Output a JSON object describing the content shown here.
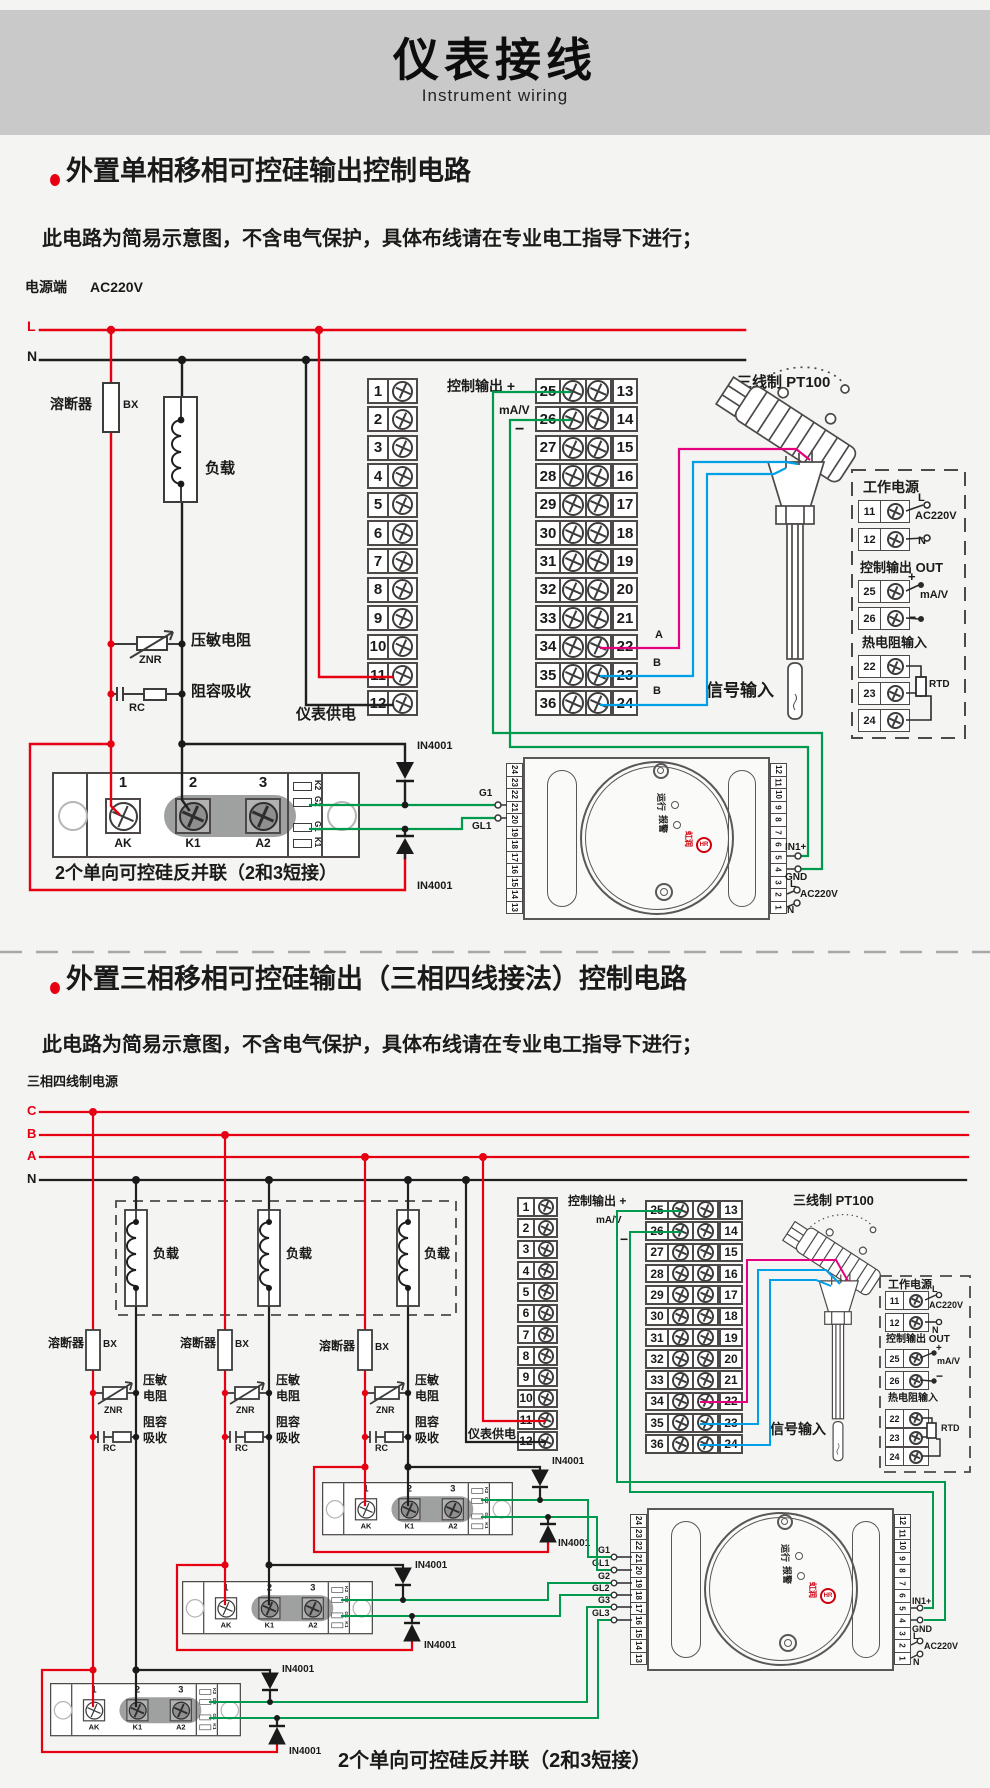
{
  "header": {
    "title": "仪表接线",
    "subtitle": "Instrument wiring"
  },
  "s1": {
    "title": "外置单相移相可控硅输出控制电路",
    "warning": "此电路为简易示意图，不含电气保护，具体布线请在专业电工指导下进行；",
    "power_label": "电源端",
    "power_voltage": "AC220V",
    "line_l": "L",
    "line_n": "N",
    "fuse_label": "溶断器",
    "fuse_code": "BX",
    "load_label": "负载",
    "varistor_label": "压敏电阻",
    "varistor_code": "ZNR",
    "rc_label": "阻容吸收",
    "rc_code": "RC",
    "meter_supply_label": "仪表供电",
    "ctrl_out_label": "控制输出 +",
    "ctrl_out_unit": "mA/V",
    "ctrl_out_minus": "−",
    "terminals_left": [
      "1",
      "2",
      "3",
      "4",
      "5",
      "6",
      "7",
      "8",
      "9",
      "10",
      "11",
      "12"
    ],
    "terminals_inner": [
      "25",
      "26",
      "27",
      "28",
      "29",
      "30",
      "31",
      "32",
      "33",
      "34",
      "35",
      "36"
    ],
    "terminals_outer": [
      "13",
      "14",
      "15",
      "16",
      "17",
      "18",
      "19",
      "20",
      "21",
      "22",
      "23",
      "24"
    ],
    "sig_a": "A",
    "sig_b1": "B",
    "sig_b2": "B",
    "signal_input_label": "信号输入",
    "pt100_label": "三线制 PT100",
    "diode_label": "IN4001",
    "gate_wire_g1": "G1",
    "gate_wire_gl1": "GL1",
    "caption": "2个单向可控硅反并联（2和3短接）",
    "side_panel": {
      "power_title": "工作电源",
      "t11": "11",
      "l": "L",
      "voltage": "AC220V",
      "t12": "12",
      "n": "N",
      "output_title": "控制输出 OUT",
      "t25": "25",
      "plus": "+",
      "unit": "mA/V",
      "t26": "26",
      "minus": "−",
      "rtd_title": "热电阻输入",
      "t22": "22",
      "t23": "23",
      "t24": "24",
      "rtd": "RTD"
    },
    "scr_module": {
      "nums": [
        "1",
        "2",
        "3"
      ],
      "labels": [
        "AK",
        "K1",
        "A2"
      ],
      "gates": [
        "K2",
        "G2",
        "G1",
        "K1"
      ]
    },
    "trigger": {
      "left_terminals": [
        "24",
        "23",
        "22",
        "21",
        "20",
        "19",
        "18",
        "17",
        "16",
        "15",
        "14",
        "13"
      ],
      "right_terminals": [
        "12",
        "11",
        "10",
        "9",
        "8",
        "7",
        "6",
        "5",
        "4",
        "3",
        "2",
        "1"
      ],
      "run_label": "运行",
      "alarm_label": "报警",
      "logo": "HR",
      "brand": "虹润",
      "in1": "IN1+",
      "gnd": "GND",
      "l": "L",
      "voltage": "AC220V",
      "n": "N"
    }
  },
  "s2": {
    "title": "外置三相移相可控硅输出（三相四线接法）控制电路",
    "warning": "此电路为简易示意图，不含电气保护，具体布线请在专业电工指导下进行；",
    "power_label": "三相四线制电源",
    "phase_c": "C",
    "phase_b": "B",
    "phase_a": "A",
    "line_n": "N",
    "load_labels": [
      "负载",
      "负载",
      "负载"
    ],
    "fuse_label": "溶断器",
    "fuse_code": "BX",
    "varistor_l1": "压敏",
    "varistor_l2": "电阻",
    "varistor_code": "ZNR",
    "rc_l1": "阻容",
    "rc_l2": "吸收",
    "rc_code": "RC",
    "meter_supply_label": "仪表供电",
    "ctrl_out_label": "控制输出 +",
    "ctrl_out_unit": "mA/V",
    "ctrl_out_minus": "−",
    "terminals_left": [
      "1",
      "2",
      "3",
      "4",
      "5",
      "6",
      "7",
      "8",
      "9",
      "10",
      "11",
      "12"
    ],
    "terminals_inner": [
      "25",
      "26",
      "27",
      "28",
      "29",
      "30",
      "31",
      "32",
      "33",
      "34",
      "35",
      "36"
    ],
    "terminals_outer": [
      "13",
      "14",
      "15",
      "16",
      "17",
      "18",
      "19",
      "20",
      "21",
      "22",
      "23",
      "24"
    ],
    "sig_a": "A",
    "sig_b1": "B",
    "sig_b2": "B",
    "signal_input_label": "信号输入",
    "pt100_label": "三线制 PT100",
    "diode_label": "IN4001",
    "gate_wires": [
      "G1",
      "GL1",
      "G2",
      "GL2",
      "G3",
      "GL3"
    ],
    "caption": "2个单向可控硅反并联（2和3短接）",
    "side_panel": {
      "power_title": "工作电源",
      "t11": "11",
      "l": "L",
      "voltage": "AC220V",
      "t12": "12",
      "n": "N",
      "output_title": "控制输出 OUT",
      "t25": "25",
      "plus": "+",
      "unit": "mA/V",
      "t26": "26",
      "minus": "−",
      "rtd_title": "热电阻输入",
      "t22": "22",
      "t23": "23",
      "t24": "24",
      "rtd": "RTD"
    },
    "scr_module": {
      "nums": [
        "1",
        "2",
        "3"
      ],
      "labels": [
        "AK",
        "K1",
        "A2"
      ],
      "gates": [
        "K2",
        "G2",
        "G1",
        "K1"
      ]
    },
    "trigger": {
      "left_terminals": [
        "24",
        "23",
        "22",
        "21",
        "20",
        "19",
        "18",
        "17",
        "16",
        "15",
        "14",
        "13"
      ],
      "right_terminals": [
        "12",
        "11",
        "10",
        "9",
        "8",
        "7",
        "6",
        "5",
        "4",
        "3",
        "2",
        "1"
      ],
      "run_label": "运行",
      "alarm_label": "报警",
      "logo": "HR",
      "brand": "虹润",
      "in1": "IN1+",
      "gnd": "GND",
      "l": "L",
      "voltage": "AC220V",
      "n": "N"
    }
  },
  "colors": {
    "wire_red": "#e60012",
    "wire_black": "#1f1f1f",
    "wire_green": "#009a4e",
    "wire_pink": "#e4007f",
    "wire_blue": "#00a0e9"
  }
}
